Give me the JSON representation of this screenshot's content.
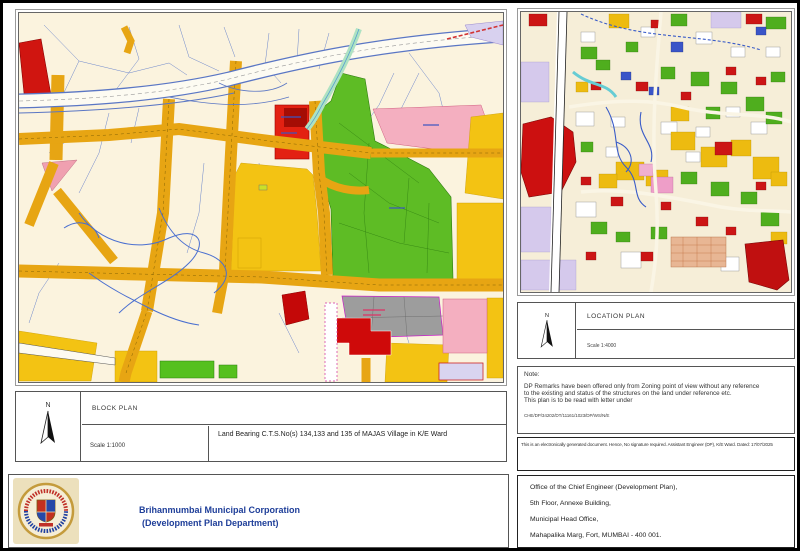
{
  "document": {
    "type_label": "Development Plan Remarks Sheet"
  },
  "block_plan": {
    "north_label": "N",
    "title": "BLOCK PLAN",
    "scale": "Scale 1:1000",
    "description": "Land Bearing C.T.S.No(s) 134,133 and 135 of MAJAS Village in K/E Ward"
  },
  "location_plan": {
    "north_label": "N",
    "title": "LOCATION PLAN",
    "scale": "Scale 1:4000"
  },
  "note": {
    "heading": "Note:",
    "line1": "DP Remarks have been offered only from Zoning point of view without any reference",
    "line2": "to the existing and status of the structures on the land under reference etc.",
    "line3": "This plan is to be read with letter under",
    "reference_no": "CHE/DP/34202/DT/11161/1023/DP/WS/N/E"
  },
  "disclaimer": "This is an electronically generated document. Hence, No signature required. Assistant Engineer (DP), K/E Ward. Dated: 17/07/2025",
  "organization": {
    "name_line1": "Brihanmumbai Municipal Corporation",
    "name_line2": "(Development Plan Department)"
  },
  "office_address": {
    "line1": "Office of the Chief Engineer (Development Plan),",
    "line2": "5th Floor, Annexe Building,",
    "line3": "Municipal Head Office,",
    "line4": "Mahapalika Marg, Fort, MUMBAI - 400 001."
  },
  "palette": {
    "map_background": "#fbf3de",
    "road_orange": "#e7a513",
    "residential_yellow": "#f3c313",
    "green_zone": "#5ebc25",
    "red_zone": "#d92211",
    "pink_zone": "#f4afc0",
    "gray_zone": "#9d9d9d",
    "lavender_zone": "#d8d1ef",
    "plot_line_blue": "#5a76c4",
    "org_title_blue": "#1e3e99"
  }
}
